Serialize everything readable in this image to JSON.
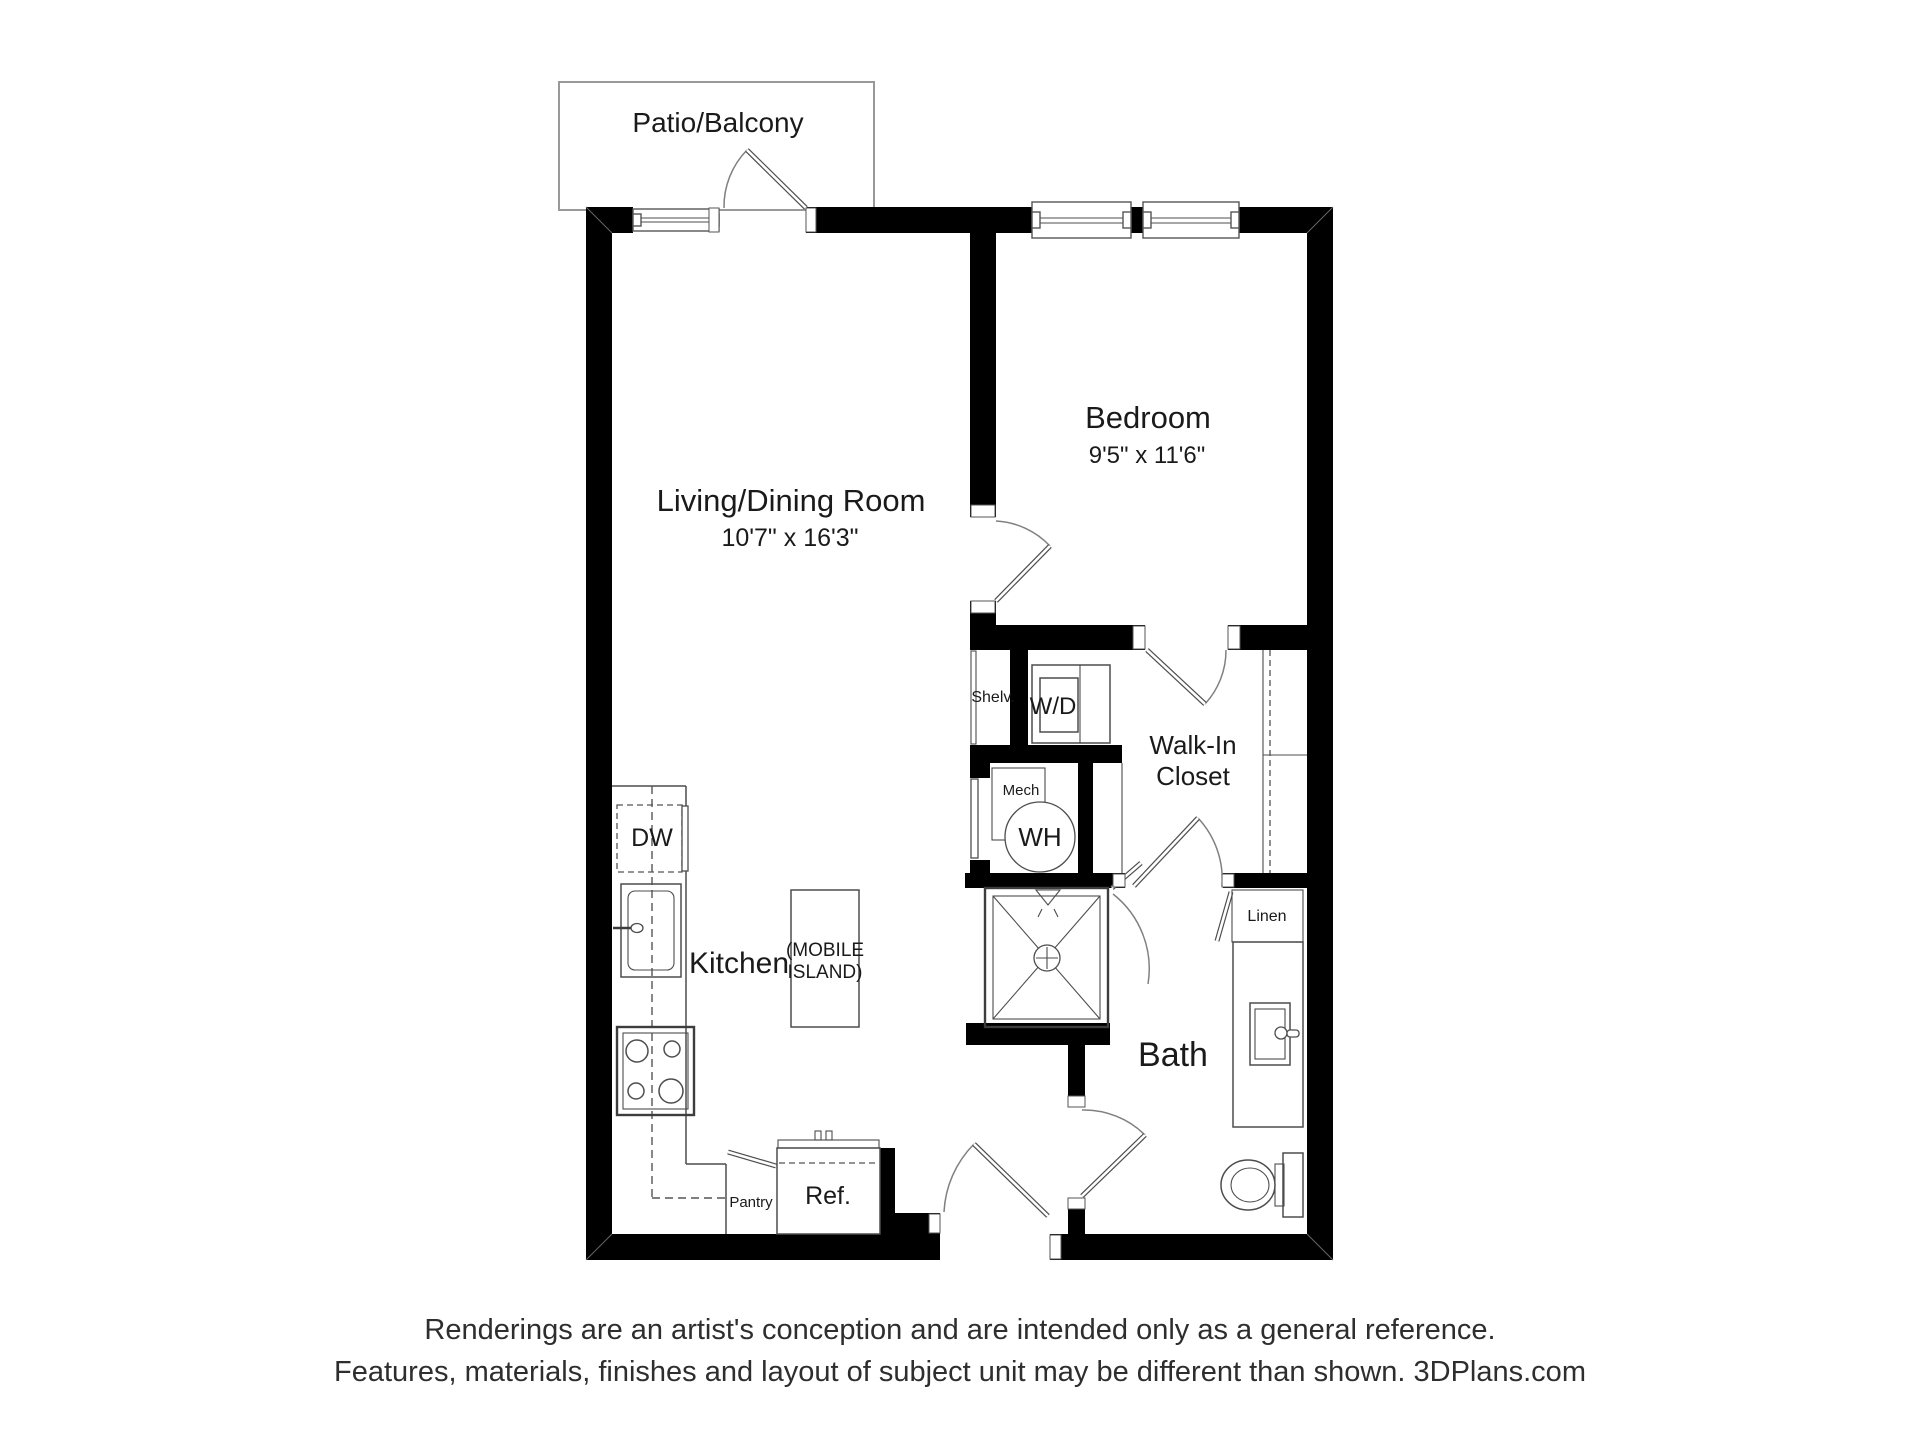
{
  "colors": {
    "background": "#ffffff",
    "wall": "#000000",
    "fixture_line": "#4d4d4d",
    "door_arc": "#808080",
    "patio_outline": "#999999",
    "label_text": "#1a1a1a",
    "footer_text": "#2e2e2e"
  },
  "plan": {
    "patio_label": "Patio/Balcony",
    "living": {
      "name": "Living/Dining Room",
      "dim": "10'7\" x 16'3\""
    },
    "bedroom": {
      "name": "Bedroom",
      "dim": "9'5\" x 11'6\""
    },
    "walk_in": {
      "line1": "Walk-In",
      "line2": "Closet"
    },
    "bath_label": "Bath",
    "kitchen_label": "Kitchen",
    "island": {
      "line1": "(MOBILE",
      "line2": "ISLAND)"
    },
    "fixtures": {
      "shelv": "Shelv.",
      "wd": "W/D",
      "mech": "Mech",
      "wh": "WH",
      "dw": "DW",
      "pantry": "Pantry",
      "ref": "Ref.",
      "linen": "Linen"
    }
  },
  "footer": {
    "line1": "Renderings are an artist's conception and are intended only as a general reference.",
    "line2": "Features, materials, finishes and layout of subject unit may be different than shown. 3DPlans.com"
  }
}
